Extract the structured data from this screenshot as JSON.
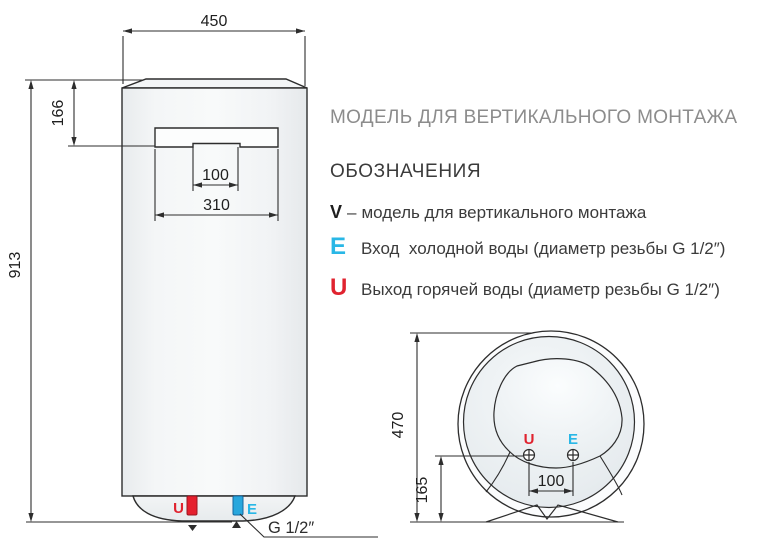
{
  "title": "МОДЕЛЬ ДЛЯ ВЕРТИКАЛЬНОГО МОНТАЖА",
  "legend": {
    "heading": "ОБОЗНАЧЕНИЯ",
    "v": {
      "symbol": "V",
      "separator": "–",
      "text": "модель для вертикального монтажа"
    },
    "e": {
      "symbol": "E",
      "text": "Вход  холодной воды (диаметр резьбы G 1/2″)"
    },
    "u": {
      "symbol": "U",
      "text": "Выход горячей воды (диаметр резьбы G 1/2″)"
    }
  },
  "front_view": {
    "width_mm": "450",
    "panel_offset_mm": "166",
    "height_mm": "913",
    "panel_cutout_mm": "100",
    "panel_width_mm": "310",
    "hot_outlet": "U",
    "cold_inlet": "E",
    "thread": "G 1/2″"
  },
  "bottom_view": {
    "depth_mm": "470",
    "ports_offset_mm": "165",
    "ports_spacing_mm": "100",
    "hot_outlet": "U",
    "cold_inlet": "E"
  },
  "colors": {
    "hot_red": "#e0232f",
    "cold_cyan": "#29b7e6",
    "line_dark": "#2d2d2d",
    "title_gray": "#8c8c8c"
  }
}
